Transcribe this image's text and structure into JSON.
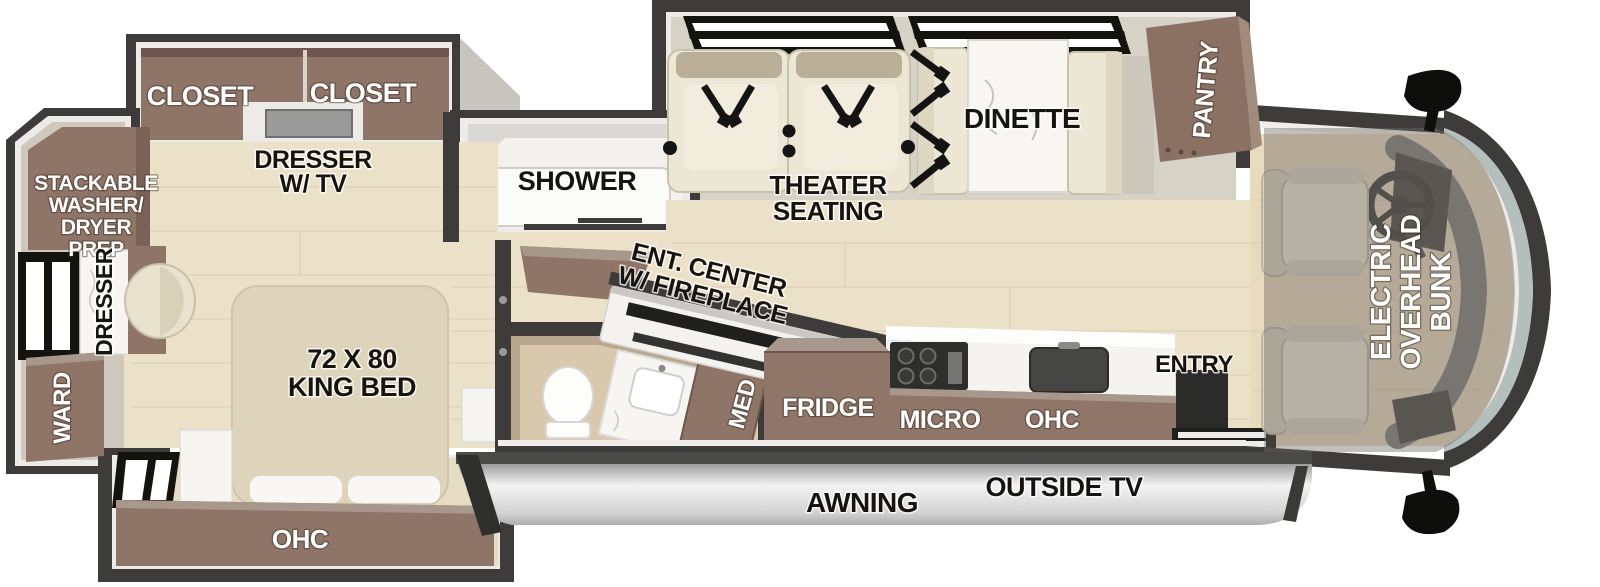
{
  "floorplan": {
    "bedroom": {
      "closet_left": "CLOSET",
      "closet_right": "CLOSET",
      "dresser_tv_line1": "DRESSER",
      "dresser_tv_line2": "W/ TV",
      "washer_line1": "STACKABLE",
      "washer_line2": "WASHER/",
      "washer_line3": "DRYER",
      "washer_line4": "PREP",
      "dresser_side": "DRESSER",
      "ward": "WARD",
      "bed_line1": "72 X 80",
      "bed_line2": "KING BED",
      "ohc": "OHC"
    },
    "bath": {
      "shower": "SHOWER",
      "med": "MED"
    },
    "living": {
      "ent_line1": "ENT. CENTER",
      "ent_line2": "W/ FIREPLACE",
      "theater_line1": "THEATER",
      "theater_line2": "SEATING",
      "dinette": "DINETTE",
      "pantry": "PANTRY"
    },
    "kitchen": {
      "fridge": "FRIDGE",
      "micro": "MICRO",
      "ohc": "OHC",
      "entry": "ENTRY"
    },
    "cab": {
      "bunk_line1": "ELECTRIC",
      "bunk_line2": "OVERHEAD",
      "bunk_line3": "BUNK"
    },
    "exterior": {
      "awning": "AWNING",
      "outside_tv": "OUTSIDE TV"
    },
    "colors": {
      "wall": "#3d3c3a",
      "cabinet_brown": "#8e7568",
      "cabinet_brown_light": "#a8988c",
      "wood_floor": "#ebe1c9",
      "slide_floor": "#d6d2c6",
      "lining_white": "#ecebe7",
      "upholstery": "#ece7d4",
      "upholstery_trim": "#b9ae97",
      "marble": "#f6f5f2",
      "bath_floor": "#d8c9ad",
      "bath_wall_band": "#b9a88f",
      "windshield_glass": "#b4bebd",
      "awning_silver": "#d9d9d9",
      "bunk_overlay": "rgba(110,106,99,0.42)"
    }
  }
}
